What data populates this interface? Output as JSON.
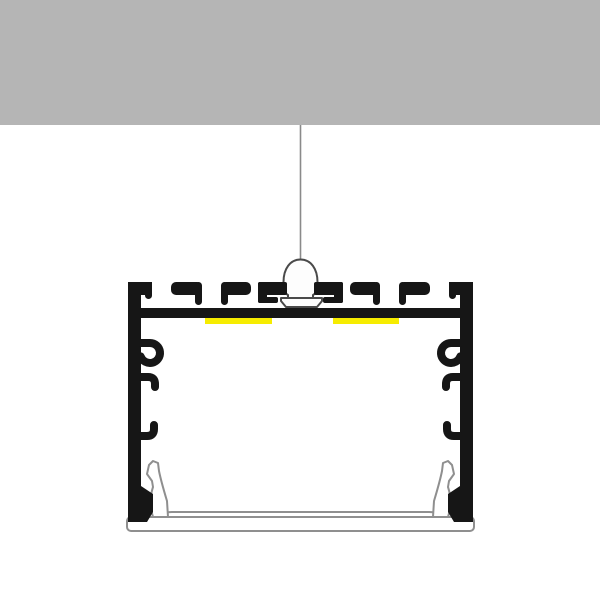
{
  "meta": {
    "title": "LED aluminium profile suspended from ceiling - cross-section diagram",
    "illustration_type": "technical-line-drawing",
    "components": [
      "ceiling",
      "suspension-wire",
      "suspension-mount",
      "aluminium-profile-body",
      "mounting-slot",
      "screw-boss-hooks",
      "led-strips",
      "diffuser-cover"
    ]
  },
  "colors": {
    "background": "#ffffff",
    "ceiling": "#b5b5b5",
    "wire": "#8a8a8a",
    "profile": "#161616",
    "led": "#f6ec00",
    "mount_fill": "#fdfdfd",
    "mount_outline": "#4a4a4a",
    "diffuser_fill": "#ffffff",
    "diffuser_outline": "#8f8f8f"
  }
}
